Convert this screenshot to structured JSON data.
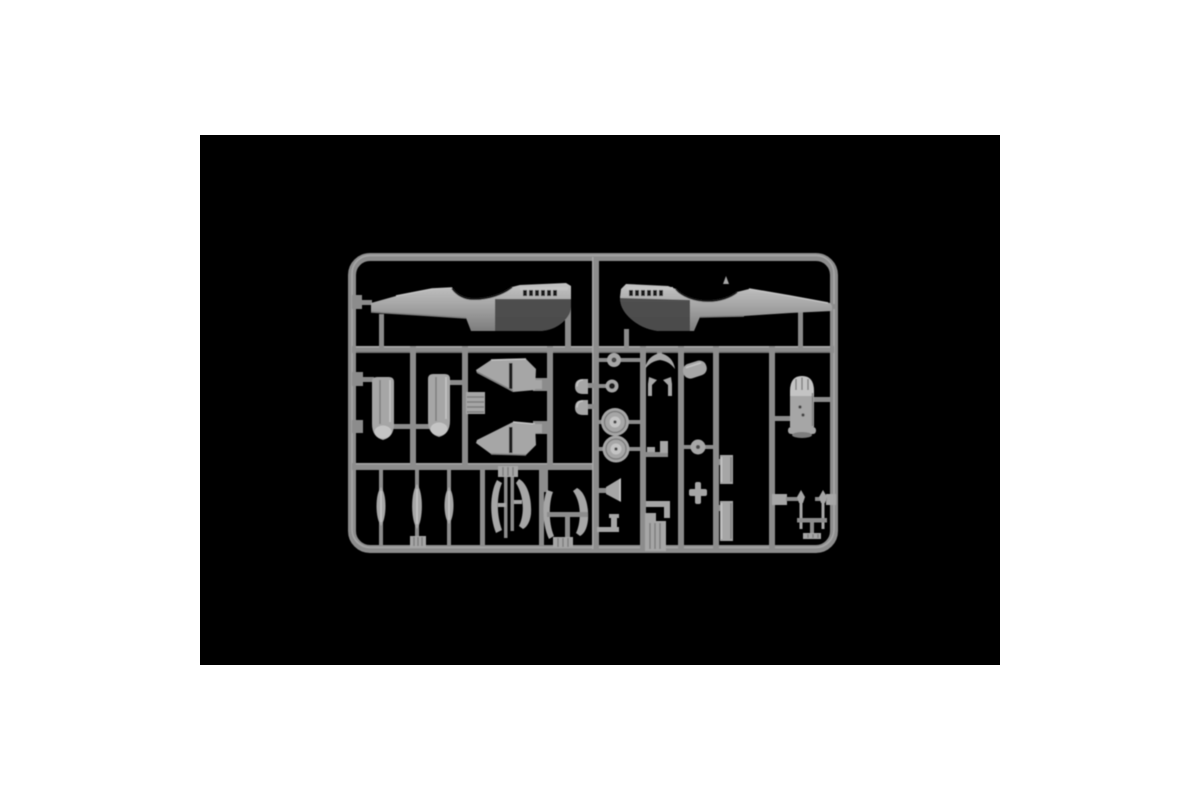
{
  "photo": {
    "subject": "plastic-model-kit-sprue",
    "backdrop": "black-rectangle-on-white",
    "visible_text": "",
    "parts": [
      "fuselage-half-left",
      "fuselage-half-right",
      "engine-cowling-half-1",
      "engine-cowling-half-2",
      "wing-half-upper",
      "wing-half-lower",
      "ribbed-panel",
      "dome-cap-1",
      "dome-cap-2",
      "small-wheel",
      "wheel-ring",
      "main-wheel-1",
      "main-wheel-2",
      "headrest-crescent",
      "gear-strut-small-1",
      "gear-strut-small-2",
      "intake-fairing",
      "rod-bracket",
      "small-disc",
      "cross-fitting",
      "radiator-plate-1",
      "radiator-plate-2",
      "engine-block",
      "tail-gear-assembly",
      "funnel-part",
      "elbow-fitting",
      "louvered-block",
      "angle-bracket",
      "drop-tank-half-1",
      "drop-tank-half-2",
      "drop-tank-half-3",
      "ribbed-foot",
      "gear-door-set-1",
      "gear-door-set-2"
    ]
  },
  "colors": {
    "canvas": "#ffffff",
    "backdrop": "#000000",
    "runner": "#8c8c8c",
    "runner_hi": "#b4b4b4",
    "runner_lo": "#5e5e5e",
    "plastic": "#a6a6a6",
    "plastic_light": "#c4c4c4",
    "plastic_mid": "#7d7d7d",
    "plastic_dark": "#464646",
    "shadow": "#1d1d1d"
  }
}
